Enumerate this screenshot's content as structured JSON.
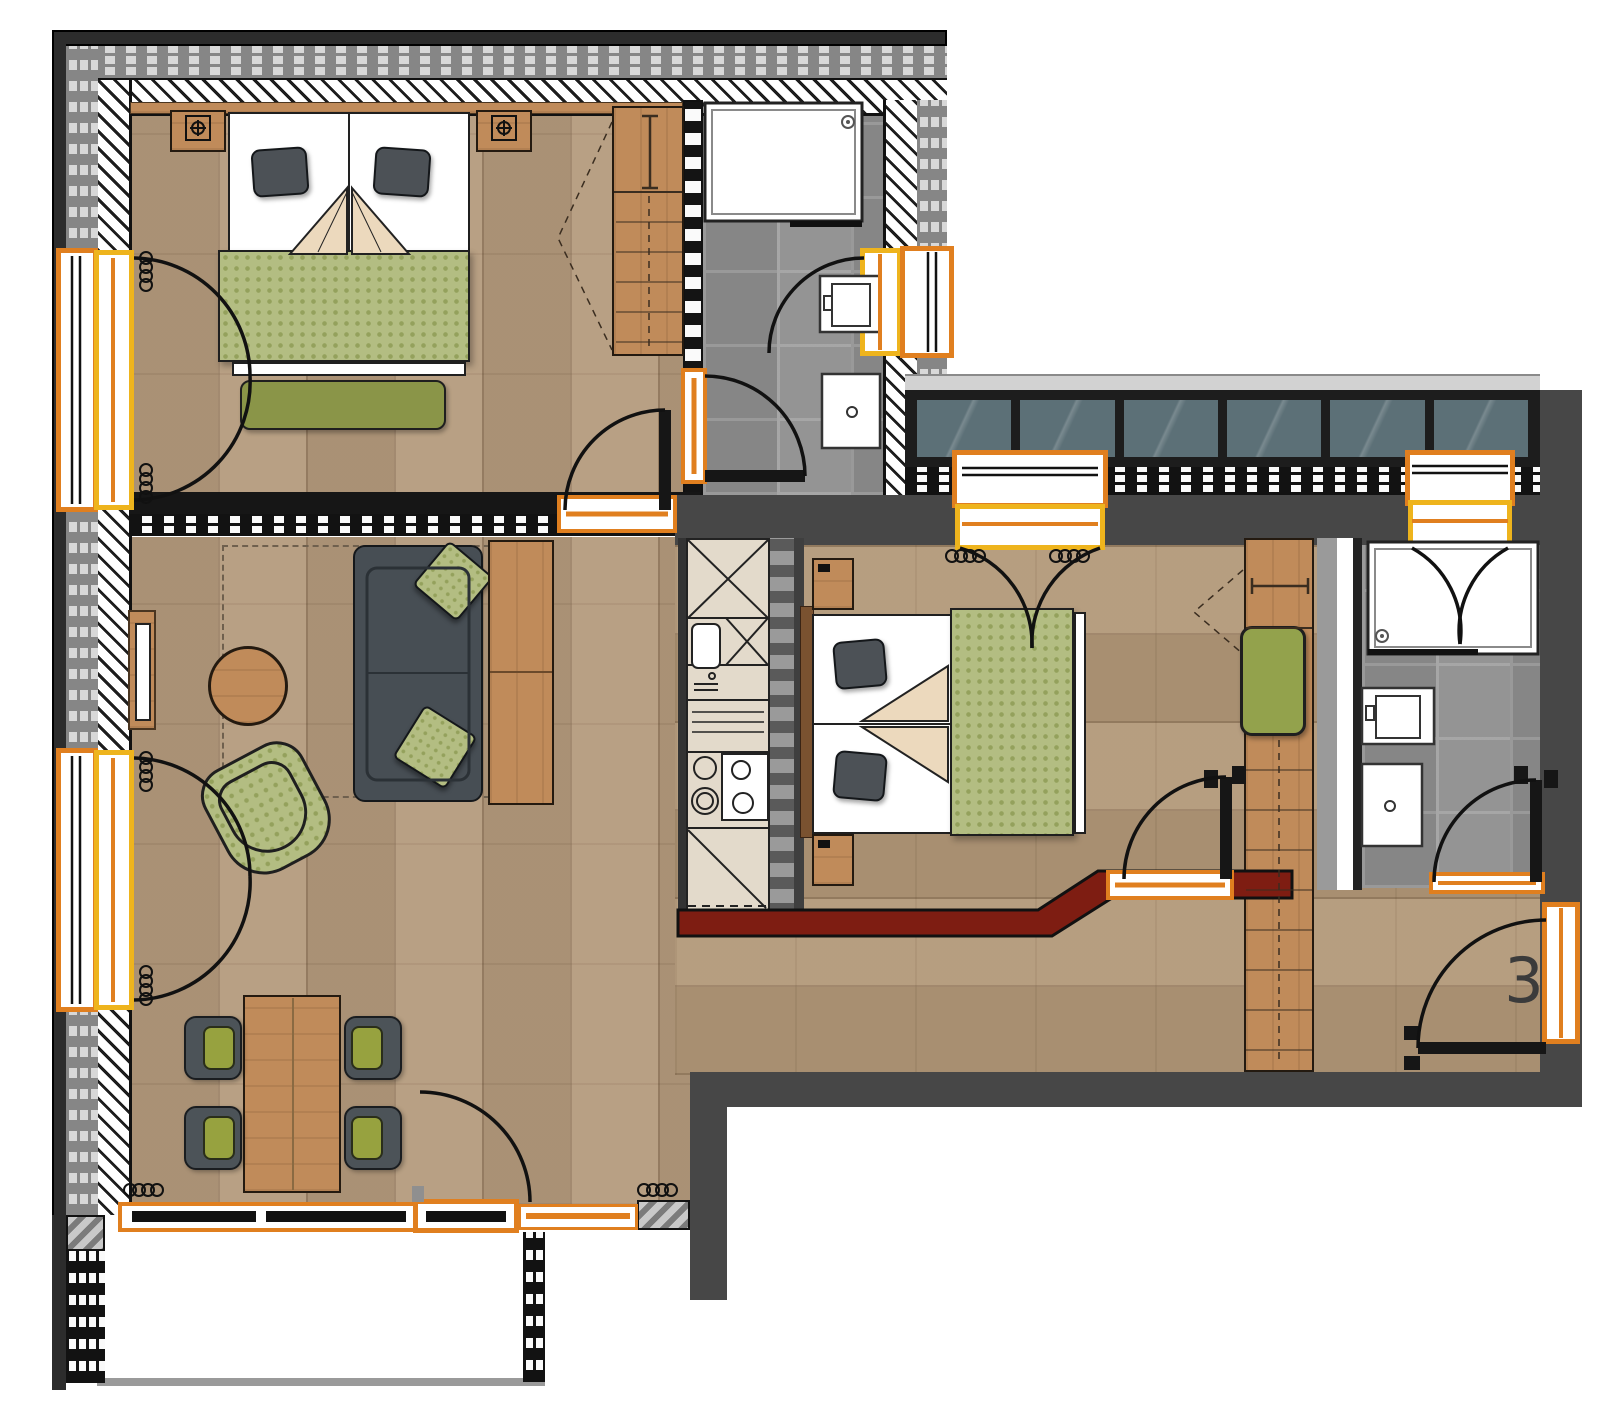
{
  "unit": {
    "number": "3"
  },
  "palette": {
    "accent_orange": "#e07f1f",
    "accent_yellow": "#eeb41d",
    "wall_dark": "#474747",
    "wall_red": "#7e1d12",
    "glass_teal": "#5c7077",
    "floor_wood": "#b49a7c",
    "tile_grey": "#8d8d8d",
    "fabric_green": "#b3bd82",
    "fabric_olive": "#8a9548",
    "sofa_grey": "#474e54",
    "furniture_wood": "#c08b5a"
  }
}
